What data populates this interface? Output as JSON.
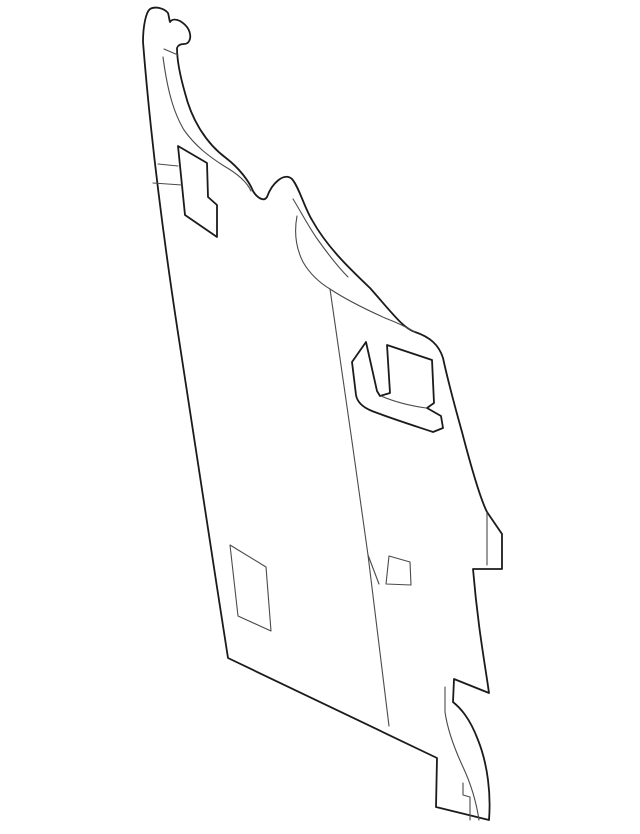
{
  "canvas": {
    "width": 640,
    "height": 834,
    "background_color": "#ffffff"
  },
  "drawing": {
    "description": "monochrome technical line drawing of an automotive separator panel part, no text or labels visible",
    "outer_stroke_color": "#1b1b1b",
    "outer_stroke_width": 1.8,
    "inner_stroke_color": "#4a4a4a",
    "inner_stroke_width": 1.1,
    "paths": [
      {
        "name": "part-outline",
        "kind": "outer",
        "d": "M 143,42 C 150,130 163,235 178,333 C 193,435 211,548 228,658 L 437,758 L 436,807 L 489,820 C 491,795 488,765 478,740 C 469,716 459,707 453,702 L 454,679 L 489,693 C 485,664 478,628 473,569 L 502,569 L 502,534 L 487,512 C 479,496 468,455 462,432 C 455,407 448,381 443,358 C 439,345 430,337 415,332 C 403,328 393,314 370,288 C 349,268 327,247 312,220 C 305,209 299,187 292,179 C 284,172 272,183 267,197 C 264,202 257,198 253,191 C 249,181 239,168 226,158 C 207,144 192,121 185,93 C 181,79 177,61 177,48 C 178,45 181,44 184,44 C 189,44 191,39 190,34 C 189,28 185,24 180,21 C 176,19 172,19 170,22 C 169,19 169,16 168,13 C 164,8 155,6 150,9 C 146,12 143,26 143,42 Z"
      },
      {
        "name": "hook-inner-edge-curve",
        "kind": "inner",
        "d": "M 163,57 C 168,95 175,115 184,130 C 196,147 210,157 224,166 C 238,174 247,182 251,191"
      },
      {
        "name": "hook-notch-tick",
        "kind": "inner",
        "d": "M 164,49 L 178,55"
      },
      {
        "name": "hump-inner-edge-a",
        "kind": "inner",
        "d": "M 293,199 C 300,210 308,226 318,240 C 328,254 337,266 348,277"
      },
      {
        "name": "hump-inner-edge-b",
        "kind": "inner",
        "d": "M 297,216 C 294,232 296,248 303,262 C 310,274 320,283 330,289 C 345,299 365,309 385,318 C 398,323 408,328 415,332"
      },
      {
        "name": "fold-line",
        "kind": "inner",
        "d": "M 330,289 C 342,372 356,468 368,555 L 389,726"
      },
      {
        "name": "fold-branch-line",
        "kind": "inner",
        "d": "M 368,555 L 379,584"
      },
      {
        "name": "upper-cutout",
        "kind": "outer",
        "d": "M 178,146 L 207,163 L 208,197 L 217,205 L 217,237 L 185,215 Z"
      },
      {
        "name": "upper-cutout-tick-1",
        "kind": "inner",
        "d": "M 158,164 L 178,166"
      },
      {
        "name": "upper-cutout-tick-2",
        "kind": "inner",
        "d": "M 153,183 L 182,185"
      },
      {
        "name": "hook-shaped-cutout",
        "kind": "outer",
        "d": "M 352,362 L 366,342 L 377,391 L 380,396 L 390,393 L 387,345 L 432,360 L 434,403 L 427,408 L 441,416 L 443,428 L 433,432 C 412,425 390,418 372,411 C 362,407 357,401 356,395 Z"
      },
      {
        "name": "hook-shaped-cutout-inner-edge",
        "kind": "inner",
        "d": "M 381,396 C 395,402 412,406 426,408"
      },
      {
        "name": "parallelogram-cutout",
        "kind": "inner",
        "d": "M 230,545 L 266,567 L 271,631 L 238,616 Z"
      },
      {
        "name": "mid-box-cutout",
        "kind": "inner",
        "d": "M 389,556 L 410,562 L 411,585 L 386,584 Z"
      },
      {
        "name": "right-notch-inner-line",
        "kind": "inner",
        "d": "M 487,513 L 487,565"
      },
      {
        "name": "foot-inner-curve",
        "kind": "inner",
        "d": "M 445,687 L 445,712 C 448,733 456,752 463,767 C 470,782 476,800 479,820"
      },
      {
        "name": "foot-inner-tick",
        "kind": "inner",
        "d": "M 463,783 L 463,795 L 470,797 L 470,820"
      }
    ]
  }
}
